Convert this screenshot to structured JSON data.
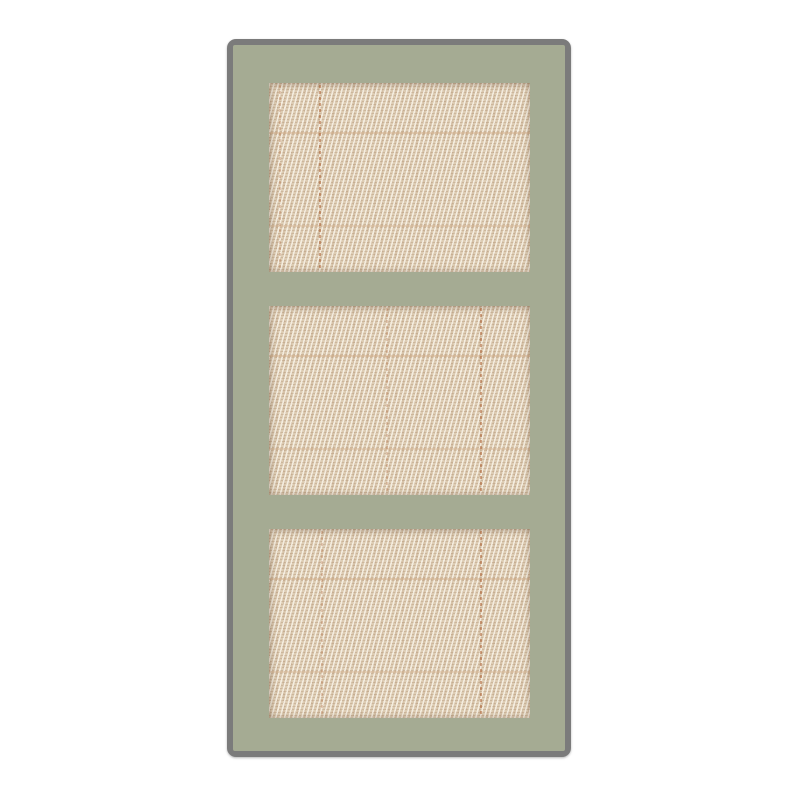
{
  "image": {
    "subject": "Sage green frame door with three inset woven cane webbing panels on a white background"
  },
  "colors": {
    "background_white": "#ffffff",
    "frame_green": "#a5ab93",
    "outline_gray": "#7b7b7b",
    "weave_base": "#ddccb3",
    "weave_highlight": "#f4eee1",
    "weave_shadow": "#a67a52",
    "weave_accent_rust": "#ad6336"
  },
  "door": {
    "panel_count": 3,
    "panels": [
      {
        "position": "top"
      },
      {
        "position": "middle"
      },
      {
        "position": "bottom"
      }
    ]
  }
}
